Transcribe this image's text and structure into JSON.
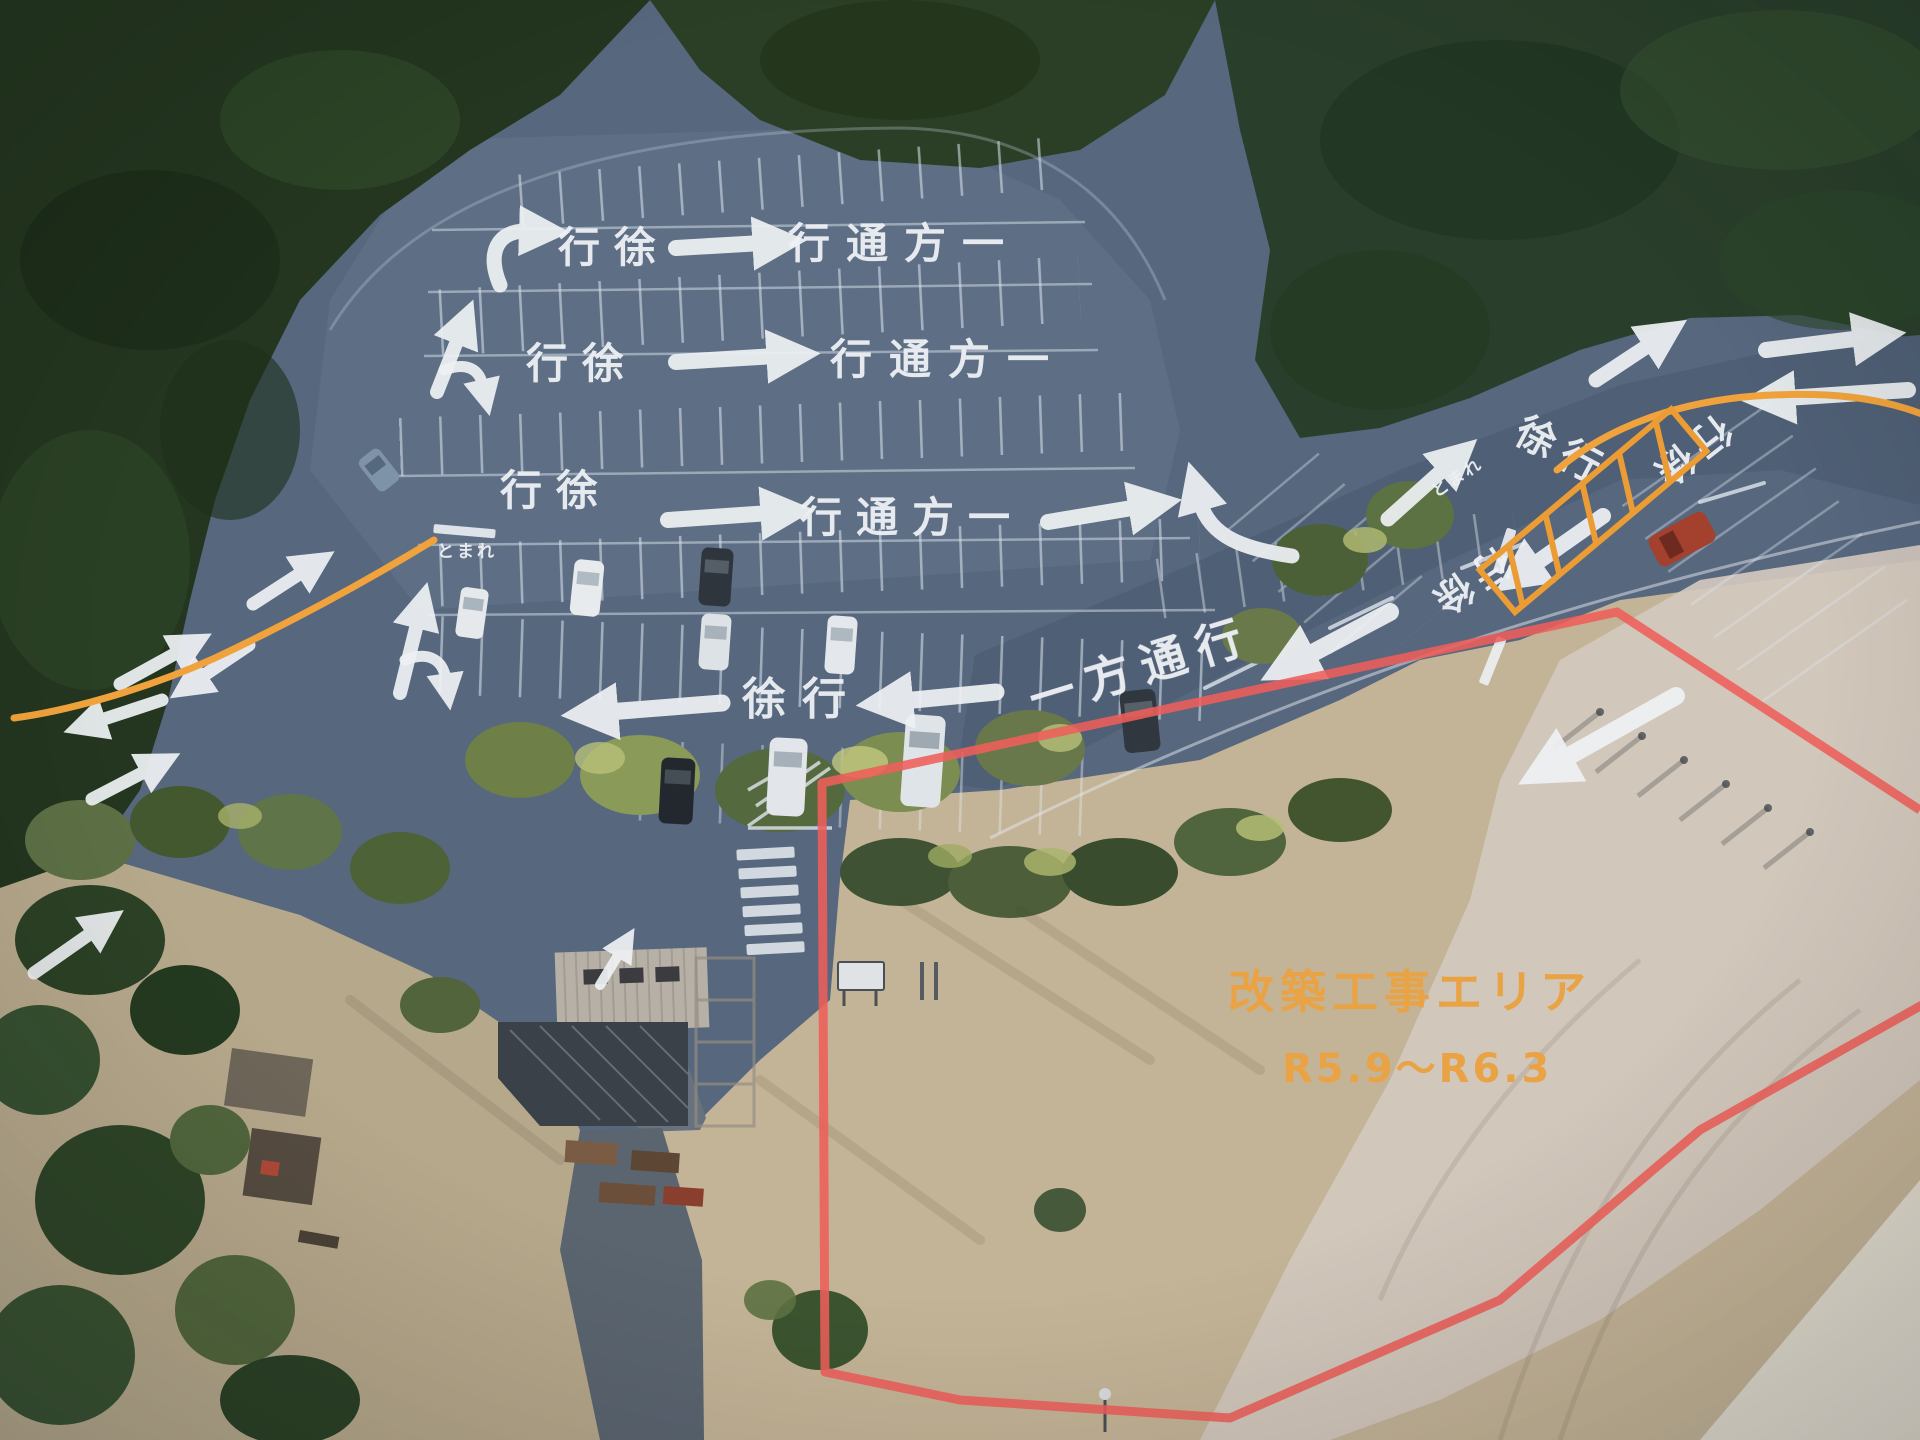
{
  "map": {
    "kind": "annotated-aerial-parking-map",
    "pavement_texts": {
      "row_a_left": "行徐",
      "row_a_right": "行通方一",
      "row_b_left": "行徐",
      "row_b_right": "行通方一",
      "row_c_left": "行徐",
      "row_c_right": "行通方一",
      "row_d_slow": "徐行",
      "row_d_one_way": "一方通行",
      "east_slow_diagonal": "徐行",
      "east_slow_inverted": "行徐",
      "entrance_slow_inverted": "行徐",
      "stop_west": "とまれ",
      "stop_east": "とまれ"
    },
    "construction": {
      "label": "改築工事エリア",
      "period": "R5.9～R6.3",
      "label_color": "#e9a344",
      "boundary_color": "#ee5e5a"
    },
    "route_color": "#f0a33c",
    "marking_color": "#eef1f4"
  }
}
